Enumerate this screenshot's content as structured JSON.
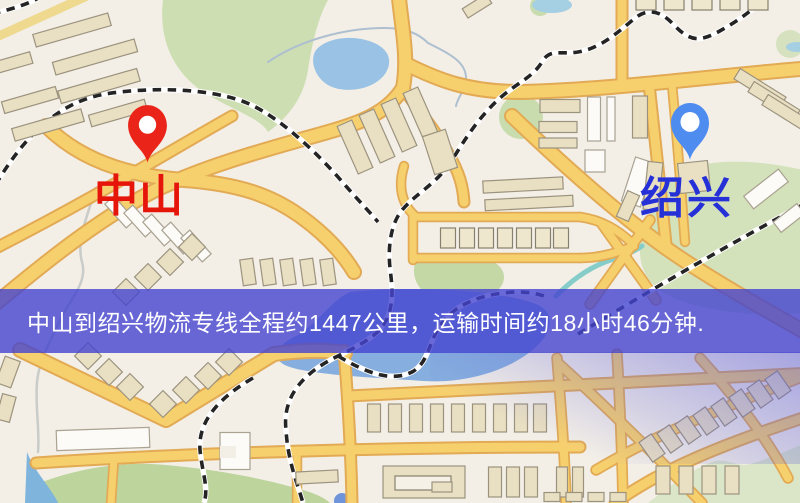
{
  "screen": {
    "width": 800,
    "height": 503
  },
  "map": {
    "description": "city-road-map",
    "origin": {
      "name": "中山",
      "pin_color": "#ea2418",
      "label_color": "#e6150a"
    },
    "destination": {
      "name": "绍兴",
      "pin_color": "#4f8cf0",
      "label_color": "#2531d6"
    },
    "banner": {
      "text": "中山到绍兴物流专线全程约1447公里，运输时间约18小时46分钟.",
      "background_color": "#4444cf",
      "text_color": "#ffffff"
    },
    "route": {
      "from": "中山",
      "to": "绍兴",
      "distance": "约1447公里",
      "duration": "约18小时46分钟"
    },
    "palette": {
      "background": "#f3efe7",
      "road": "#f7d06e",
      "water": "#93bfe4",
      "park": "#cfe0b4",
      "railway": "#242424"
    }
  }
}
